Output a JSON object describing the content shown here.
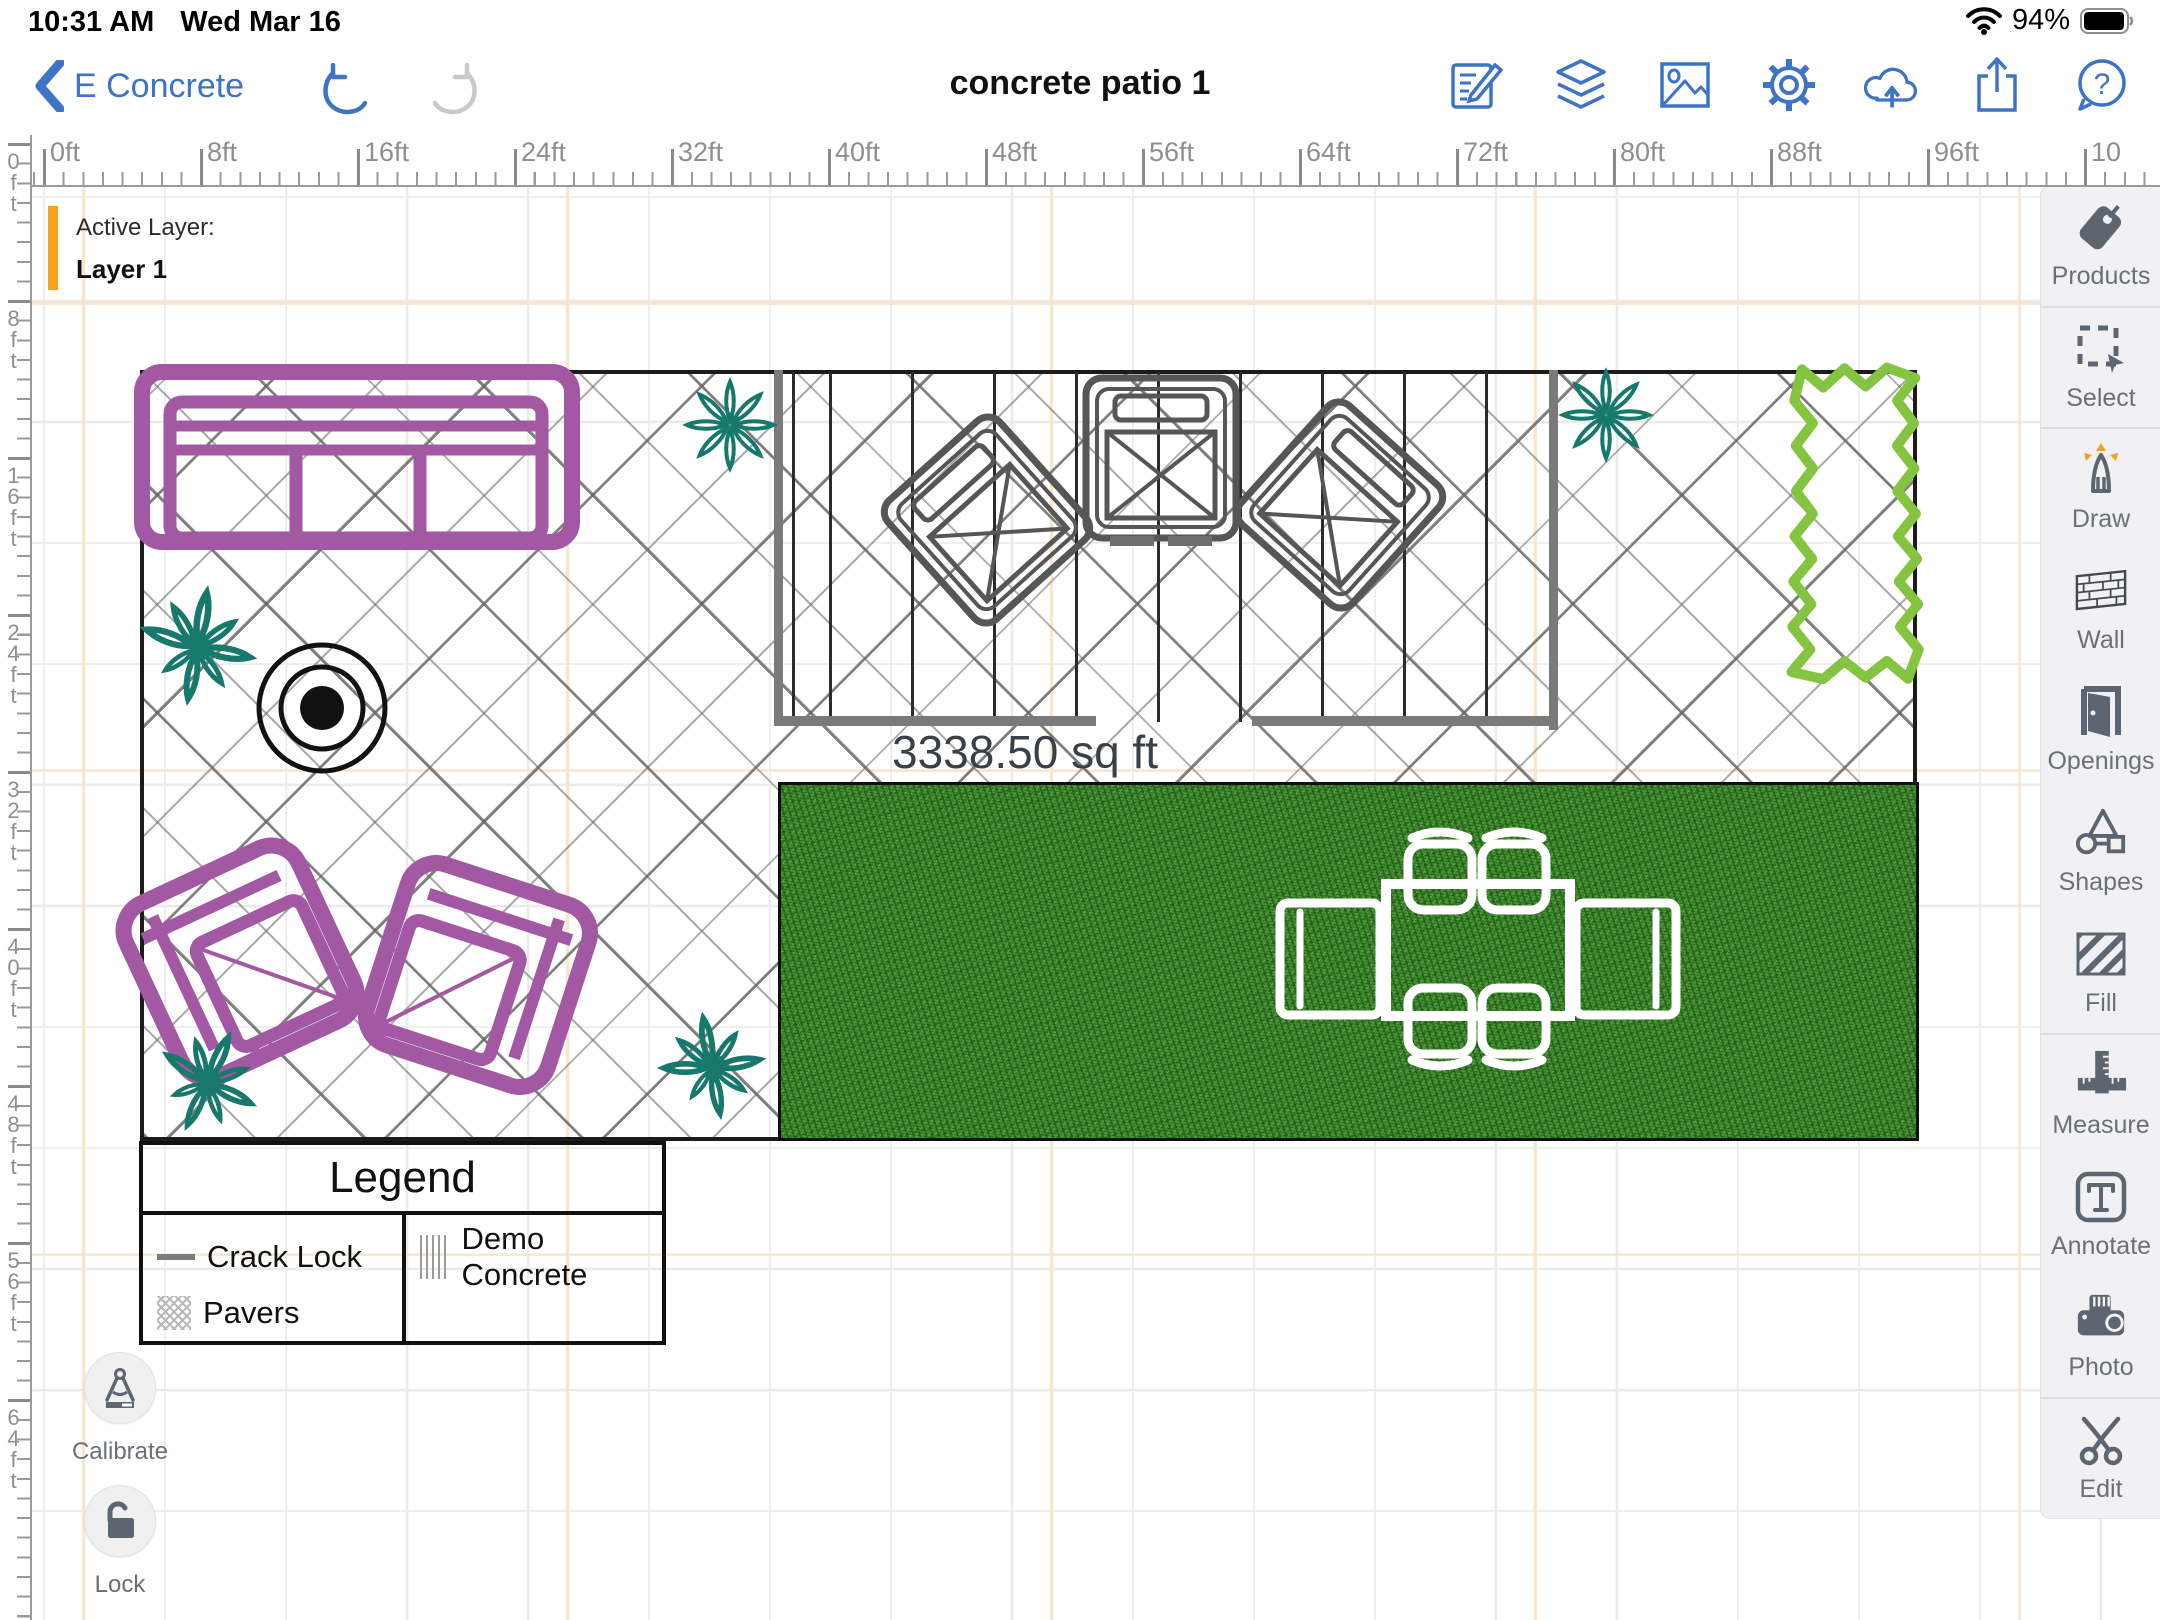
{
  "status_bar": {
    "time": "10:31 AM",
    "date": "Wed Mar 16",
    "battery_percent": "94%"
  },
  "toolbar": {
    "back_label": "E Concrete",
    "title": "concrete patio 1"
  },
  "active_layer": {
    "label": "Active Layer:",
    "value": "Layer 1"
  },
  "rulers": {
    "top_labels": [
      "0ft",
      "8ft",
      "16ft",
      "24ft",
      "32ft",
      "40ft",
      "48ft",
      "56ft",
      "64ft",
      "72ft",
      "80ft",
      "88ft",
      "96ft",
      "10"
    ],
    "left_labels": [
      "0ft",
      "8ft",
      "16ft",
      "24ft",
      "32ft",
      "40ft",
      "48ft",
      "56ft",
      "64ft"
    ]
  },
  "canvas": {
    "area_label": "3338.50 sq ft"
  },
  "legend": {
    "title": "Legend",
    "items": [
      {
        "label": "Crack Lock",
        "swatch": "line"
      },
      {
        "label": "Pavers",
        "swatch": "hatch"
      },
      {
        "label": "Demo Concrete",
        "swatch": "vlines"
      }
    ]
  },
  "floating_buttons": {
    "calibrate": "Calibrate",
    "lock": "Lock"
  },
  "sidebar": {
    "items": [
      {
        "icon": "tag-icon",
        "label": "Products"
      },
      {
        "icon": "select-icon",
        "label": "Select"
      },
      {
        "icon": "draw-icon",
        "label": "Draw"
      },
      {
        "icon": "wall-icon",
        "label": "Wall"
      },
      {
        "icon": "openings-icon",
        "label": "Openings"
      },
      {
        "icon": "shapes-icon",
        "label": "Shapes"
      },
      {
        "icon": "fill-icon",
        "label": "Fill"
      },
      {
        "icon": "measure-icon",
        "label": "Measure"
      },
      {
        "icon": "annotate-icon",
        "label": "Annotate"
      },
      {
        "icon": "photo-icon",
        "label": "Photo"
      },
      {
        "icon": "edit-icon",
        "label": "Edit"
      }
    ]
  },
  "colors": {
    "accent_blue": "#3D74C7",
    "furniture_purple": "#A358A3",
    "plant_teal": "#17786C",
    "hedge_green": "#85C440",
    "active_layer_orange": "#F5A11C",
    "grass_green": "#41902f"
  }
}
